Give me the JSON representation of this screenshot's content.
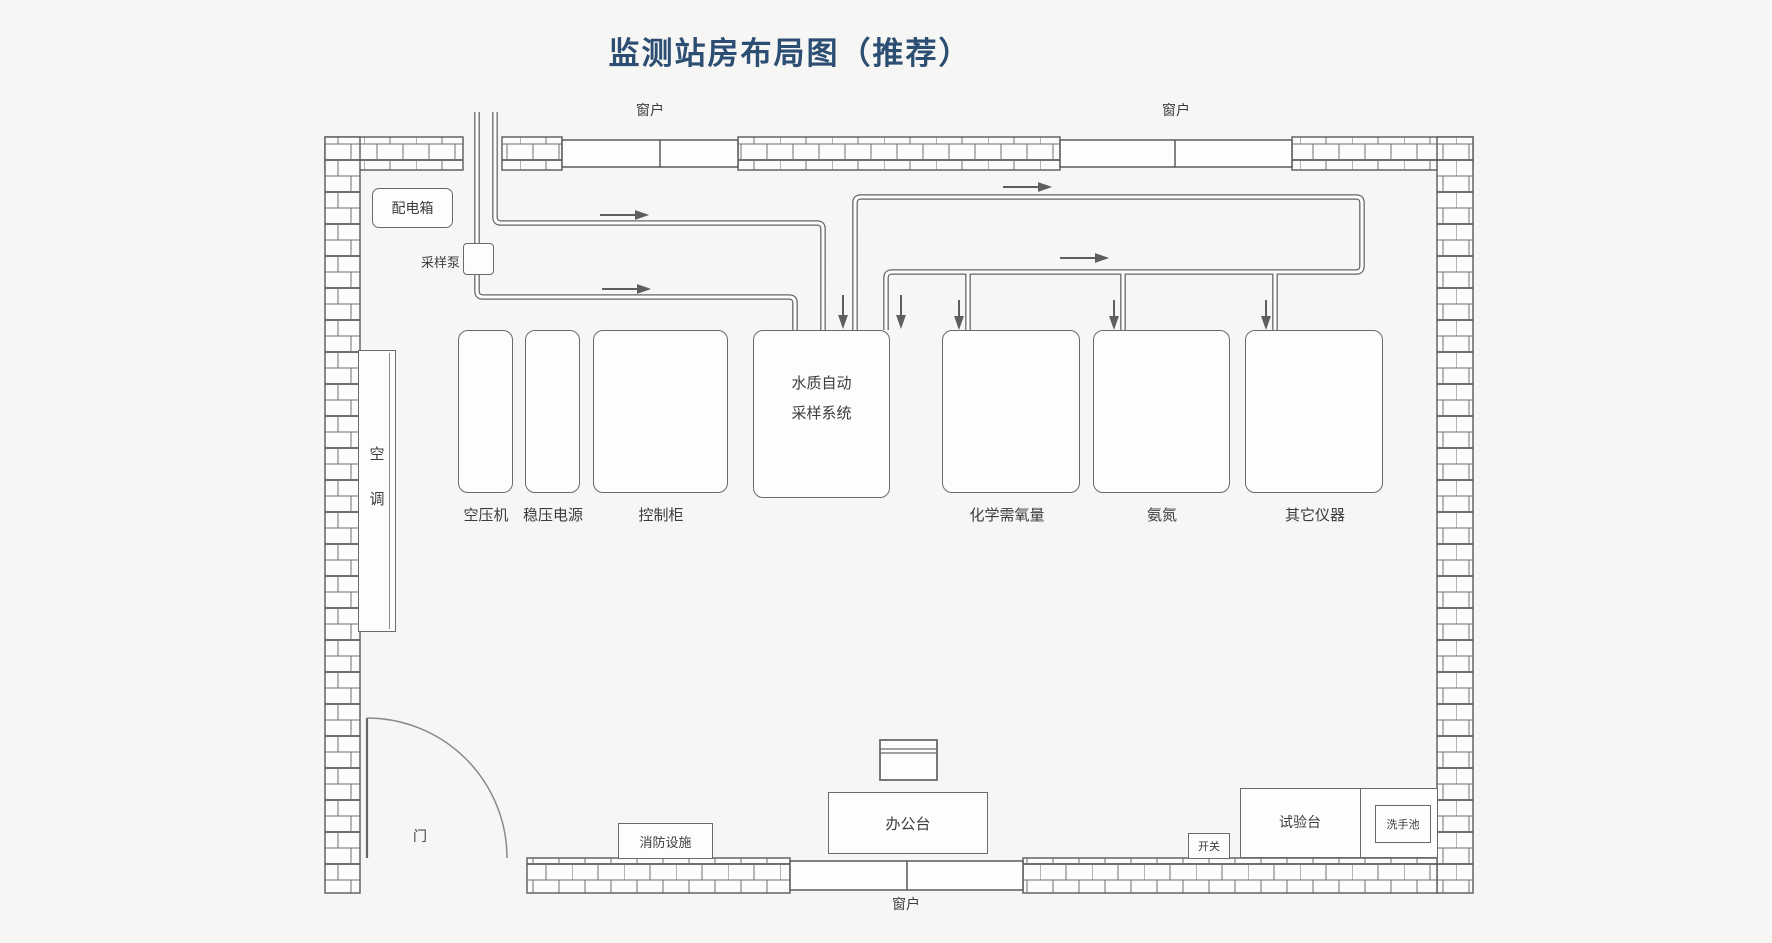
{
  "title": "监测站房布局图（推荐）",
  "colors": {
    "title_blue": "#2d4e73",
    "line_gray": "#606060",
    "wall_line": "#5a5a5a"
  },
  "windows": {
    "top_left_label": "窗户",
    "top_right_label": "窗户",
    "bottom_label": "窗户"
  },
  "fixtures": {
    "distribution_box": "配电箱",
    "sampling_pump": "采样泵",
    "air_conditioner": "空调",
    "door": "门",
    "fire_equipment": "消防设施",
    "office_desk": "办公台",
    "switch": "开关",
    "test_bench": "试验台",
    "sink": "洗手池"
  },
  "equipment": [
    {
      "id": "air-compressor",
      "label": "空压机"
    },
    {
      "id": "voltage-stabilizer",
      "label": "稳压电源"
    },
    {
      "id": "control-cabinet",
      "label": "控制柜"
    },
    {
      "id": "water-auto-sampling-system",
      "label": "水质自动采样系统",
      "label_line1": "水质自动",
      "label_line2": "采样系统"
    },
    {
      "id": "cod-analyzer",
      "label": "化学需氧量"
    },
    {
      "id": "ammonia-nitrogen-analyzer",
      "label": "氨氮"
    },
    {
      "id": "other-instruments",
      "label": "其它仪器"
    }
  ]
}
